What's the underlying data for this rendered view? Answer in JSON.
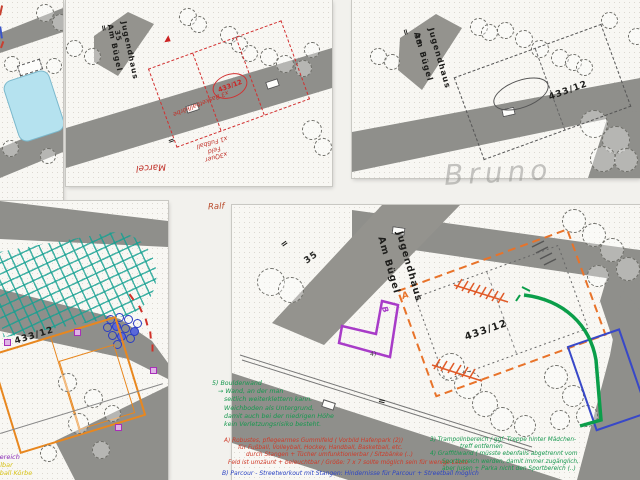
{
  "colors": {
    "red_ink": "#cf3a28",
    "green_ink": "#17984f",
    "blue_ink": "#2b44c4",
    "orange_ink": "#e8732a",
    "purple_ink": "#a83cc8",
    "teal_grid": "#14a091",
    "yellow_ink": "#d8c319",
    "pencil": "#a8a8a4"
  },
  "panel2": {
    "jugendhaus": "Jugendhaus",
    "am_buegel": "Am Bügel",
    "house_no": "35",
    "equals": "=",
    "equals2": "=",
    "parcel": "433/12",
    "hw_basketball": "x3 Basketballkörbe",
    "hw_line1": "x1 Fußball",
    "hw_line2": "Feld",
    "hw_line3": "x3Quer",
    "hw_name": "Marcel"
  },
  "panel3": {
    "jugendhaus": "Jugendhaus",
    "am_buegel": "Am Bügel",
    "house_no": "35",
    "equals": "=",
    "parcel": "433/12",
    "pencil_name": "Bruno"
  },
  "panel4": {
    "parcel": "433/12",
    "note_purple": "llinbereich",
    "note_yellow1": "l teilbar",
    "note_yellow2": "sketball Körbe"
  },
  "panel5": {
    "author": "Ralf",
    "jugendhaus": "Jugendhaus",
    "am_buegel": "Am Bügel",
    "house_no": "35",
    "equals_a": "=",
    "equals_b": "=",
    "parcel": "433/12",
    "zone_a": "A",
    "zone_b": "B",
    "zone_b_num": "4)"
  },
  "notes": {
    "green5": [
      "5) Boulderwand",
      "→ Wand, an der man",
      "seitlich weiterklettern kann.",
      "Weichboden als Untergrund,",
      "damit auch bei der niedrigen Höhe",
      "kein Verletzungsrisiko besteht."
    ],
    "redA": [
      "A) Robustes, pflegearmes Gummifeld ( Vorbild Hafenpark (2))",
      "für Fußball, Volleyball, Hockey, Handball, Basketball, etc.",
      "durch Stangen + Tücher umfunktionierbar / Sitzbänke (..)",
      "Feld ist umzäunt + beleuchtbar / Größe: 7 x 7 sollte möglich sein für wenige Leute"
    ],
    "blueB": "B) Parcour - Streetworkout mit Stangen: Hindernisse für Parcour + Streetball möglich",
    "green34": [
      "3) Trampolinbereich / ggf. Treppe hinter Mädchen-",
      "treff entfernen",
      "4) Graffitiwand ( müsste ebenfalls abgetrennt vom",
      "Sportbereich werden, damit immer zugänglich,",
      "aber Jusen + Parka nicht den Sportbereich (..)"
    ]
  }
}
